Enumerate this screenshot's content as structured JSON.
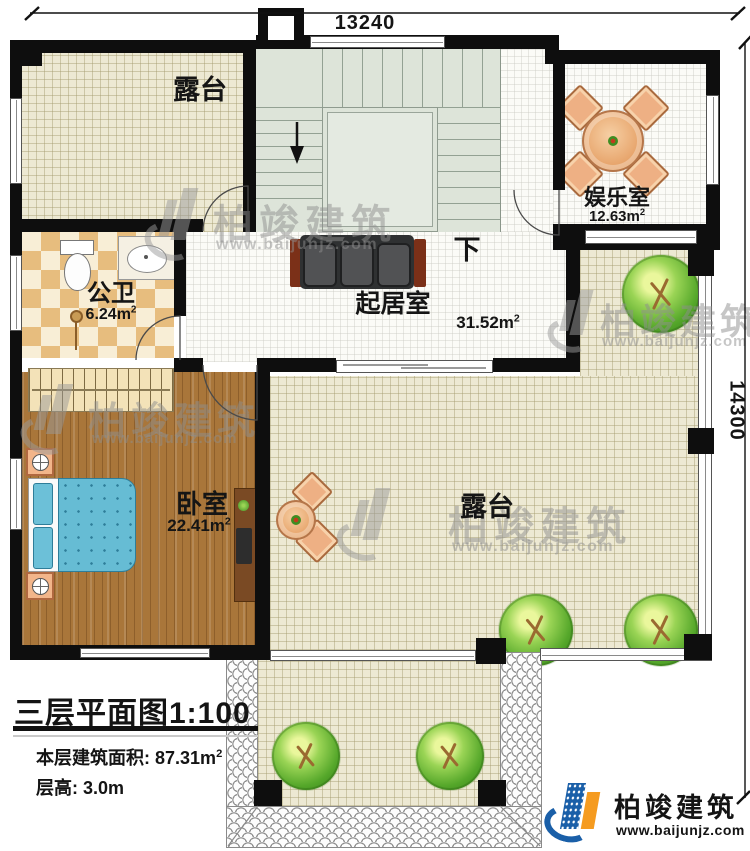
{
  "page": {
    "background": "#ffffff"
  },
  "dimensions": {
    "top": "13240",
    "right": "14300"
  },
  "rooms": {
    "terrace_top_left": {
      "label": "露台"
    },
    "stairwell": {
      "down_label": "下"
    },
    "entertainment": {
      "label": "娱乐室",
      "area_value": "12.63m",
      "area_sup": "2"
    },
    "bathroom": {
      "label": "公卫",
      "area_value": "6.24m",
      "area_sup": "2"
    },
    "living_room": {
      "label": "起居室",
      "area_value": "31.52m",
      "area_sup": "2"
    },
    "bedroom": {
      "label": "卧室",
      "area_value": "22.41m",
      "area_sup": "2"
    },
    "terrace_right": {
      "label": "露台"
    }
  },
  "title_block": {
    "plan_title": "三层平面图",
    "plan_scale": "1:100",
    "floor_area_label": "本层建筑面积:",
    "floor_area_value": "87.31m",
    "floor_area_sup": "2",
    "floor_height_label": "层高:",
    "floor_height_value": "3.0m"
  },
  "brand": {
    "name": "柏竣建筑",
    "website": "www.baijunjz.com"
  },
  "watermark": {
    "name": "柏竣建筑",
    "website": "www.baijunjz.com"
  },
  "colors": {
    "wall": "#0e0e0e",
    "terrace_floor": "#ede9d3",
    "wood_floor": "#a9763a",
    "stair_floor": "#dde4d9",
    "bed_blue": "#66bcd4",
    "brand_blue": "#1a5fa8",
    "brand_orange": "#f59b20"
  }
}
